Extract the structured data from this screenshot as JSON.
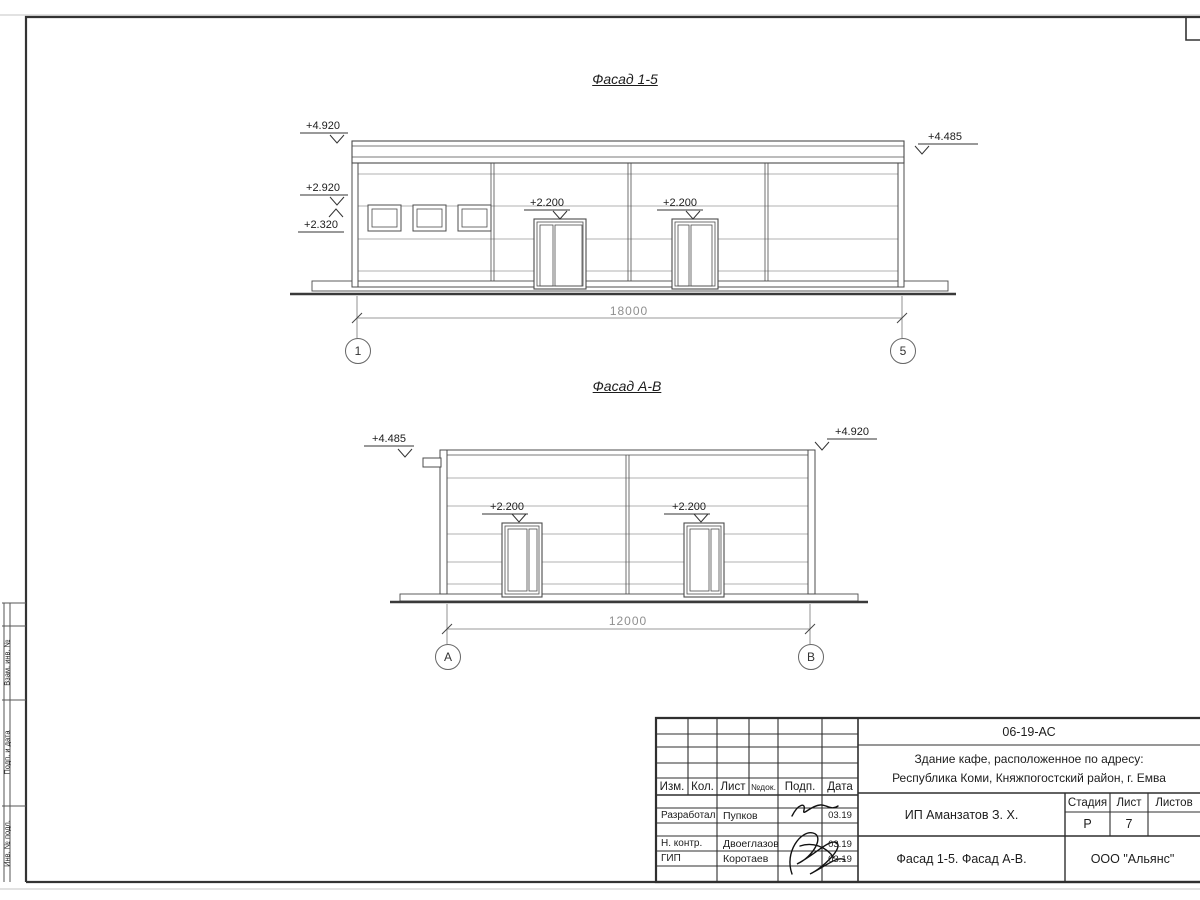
{
  "frame": {
    "left_margin_labels": {
      "vzam": "Взам. инв. №",
      "podp": "Подп. и дата",
      "inv": "Инв. № подл."
    }
  },
  "facade_15": {
    "title": "Фасад 1-5",
    "mark_4920": "+4.920",
    "mark_2920": "+2.920",
    "mark_2320": "+2.320",
    "mark_4485": "+4.485",
    "mark_door_left": "+2.200",
    "mark_door_right": "+2.200",
    "dimension": "18000",
    "axis_left": "1",
    "axis_right": "5"
  },
  "facade_ab": {
    "title": "Фасад А-В",
    "mark_4485": "+4.485",
    "mark_4920": "+4.920",
    "mark_door_left": "+2.200",
    "mark_door_right": "+2.200",
    "dimension": "12000",
    "axis_left": "А",
    "axis_right": "В"
  },
  "title_block": {
    "doc_number": "06-19-АС",
    "project_address_line1": "Здание кафе, расположенное по адресу:",
    "project_address_line2": "Республика Коми, Княжпогостский район, г. Емва",
    "col_izm": "Изм.",
    "col_kol": "Кол.",
    "col_list": "Лист",
    "col_ndok": "№док.",
    "col_podp": "Подп.",
    "col_data": "Дата",
    "rows": [
      {
        "role": "Разработал",
        "name": "Пупков",
        "date": "03.19"
      },
      {
        "role": "Н. контр.",
        "name": "Двоеглазов",
        "date": "03.19"
      },
      {
        "role": "ГИП",
        "name": "Коротаев",
        "date": "03.19"
      }
    ],
    "client": "ИП Аманзатов З. Х.",
    "stage_label": "Стадия",
    "sheet_label": "Лист",
    "sheets_label": "Листов",
    "stage_value": "Р",
    "sheet_value": "7",
    "sheet_title": "Фасад 1-5. Фасад А-В.",
    "organization": "ООО \"Альянс\""
  }
}
